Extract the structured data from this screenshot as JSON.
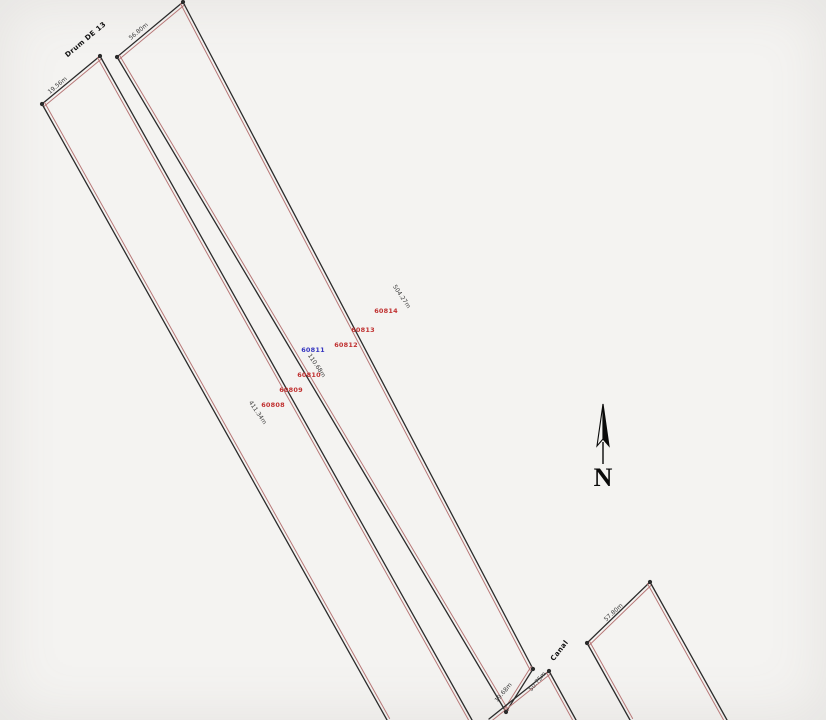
{
  "meta": {
    "background": "#f4f3f1",
    "outline_color": "#2b2b2b",
    "inner_line_color": "#b87878",
    "parcel_id_color": "#c03030",
    "highlight_id_color": "#3535c0",
    "dim_text_color": "#3a3a3a"
  },
  "parcels": [
    {
      "name": "west-strip",
      "edges": [
        {
          "x1": 42,
          "y1": 104,
          "x2": 100,
          "y2": 56,
          "ox": 1.8,
          "oy": 2.6
        },
        {
          "x1": 42,
          "y1": 104,
          "x2": 387,
          "y2": 720,
          "ox": 2.6,
          "oy": -1.5
        },
        {
          "x1": 100,
          "y1": 56,
          "x2": 472,
          "y2": 720,
          "ox": -2.6,
          "oy": 1.5
        }
      ]
    },
    {
      "name": "main-strip",
      "edges": [
        {
          "x1": 117,
          "y1": 57,
          "x2": 183,
          "y2": 2,
          "ox": 1.8,
          "oy": 2.6
        },
        {
          "x1": 117,
          "y1": 57,
          "x2": 506,
          "y2": 712,
          "ox": 2.6,
          "oy": -1.5
        },
        {
          "x1": 183,
          "y1": 2,
          "x2": 533,
          "y2": 669,
          "ox": -2.6,
          "oy": 1.5
        },
        {
          "x1": 506,
          "y1": 712,
          "x2": 533,
          "y2": 669,
          "ox": -1.8,
          "oy": -2.6
        }
      ]
    },
    {
      "name": "south-neighbor",
      "edges": [
        {
          "x1": 489,
          "y1": 719,
          "x2": 549,
          "y2": 671,
          "ox": 1.8,
          "oy": 2.6
        },
        {
          "x1": 549,
          "y1": 671,
          "x2": 576,
          "y2": 720,
          "ox": -2.6,
          "oy": 1.5
        }
      ]
    },
    {
      "name": "east-parcel",
      "edges": [
        {
          "x1": 587,
          "y1": 643,
          "x2": 650,
          "y2": 582,
          "ox": 1.8,
          "oy": 2.6
        },
        {
          "x1": 587,
          "y1": 643,
          "x2": 630,
          "y2": 720,
          "ox": 2.6,
          "oy": -1.5
        },
        {
          "x1": 650,
          "y1": 582,
          "x2": 727,
          "y2": 720,
          "ox": -2.6,
          "oy": 1.5
        }
      ]
    }
  ],
  "corner_points": [
    [
      42,
      104
    ],
    [
      100,
      56
    ],
    [
      117,
      57
    ],
    [
      183,
      2
    ],
    [
      506,
      712
    ],
    [
      533,
      669
    ],
    [
      587,
      643
    ],
    [
      650,
      582
    ],
    [
      549,
      671
    ]
  ],
  "parcel_ids": [
    {
      "label": "60808",
      "x": 273,
      "y": 405,
      "rot": 0,
      "color": "#c03030"
    },
    {
      "label": "60809",
      "x": 291,
      "y": 390,
      "rot": 0,
      "color": "#c03030"
    },
    {
      "label": "60810",
      "x": 309,
      "y": 375,
      "rot": 0,
      "color": "#c03030"
    },
    {
      "label": "60811",
      "x": 313,
      "y": 350,
      "rot": 0,
      "color": "#3535c0"
    },
    {
      "label": "60812",
      "x": 346,
      "y": 345,
      "rot": 0,
      "color": "#c03030"
    },
    {
      "label": "60813",
      "x": 363,
      "y": 330,
      "rot": 0,
      "color": "#c03030"
    },
    {
      "label": "60814",
      "x": 386,
      "y": 311,
      "rot": 0,
      "color": "#c03030"
    }
  ],
  "dim_labels": [
    {
      "text": "19.56m",
      "x": 58,
      "y": 86,
      "rot": -40
    },
    {
      "text": "56.80m",
      "x": 139,
      "y": 32,
      "rot": -40
    },
    {
      "text": "504.27m",
      "x": 401,
      "y": 297,
      "rot": 56
    },
    {
      "text": "110.68m",
      "x": 316,
      "y": 366,
      "rot": 56
    },
    {
      "text": "411.34m",
      "x": 257,
      "y": 413,
      "rot": 56
    },
    {
      "text": "57.80m",
      "x": 614,
      "y": 613,
      "rot": -43
    },
    {
      "text": "19.68m",
      "x": 504,
      "y": 693,
      "rot": -50
    },
    {
      "text": "50.75m",
      "x": 538,
      "y": 682,
      "rot": -50
    }
  ],
  "text_labels": [
    {
      "text": "Drum DE 13",
      "x": 86,
      "y": 40,
      "rot": -40
    },
    {
      "text": "Canal",
      "x": 560,
      "y": 651,
      "rot": -52
    }
  ],
  "north": {
    "label": "N",
    "x": 602,
    "y": 480
  }
}
